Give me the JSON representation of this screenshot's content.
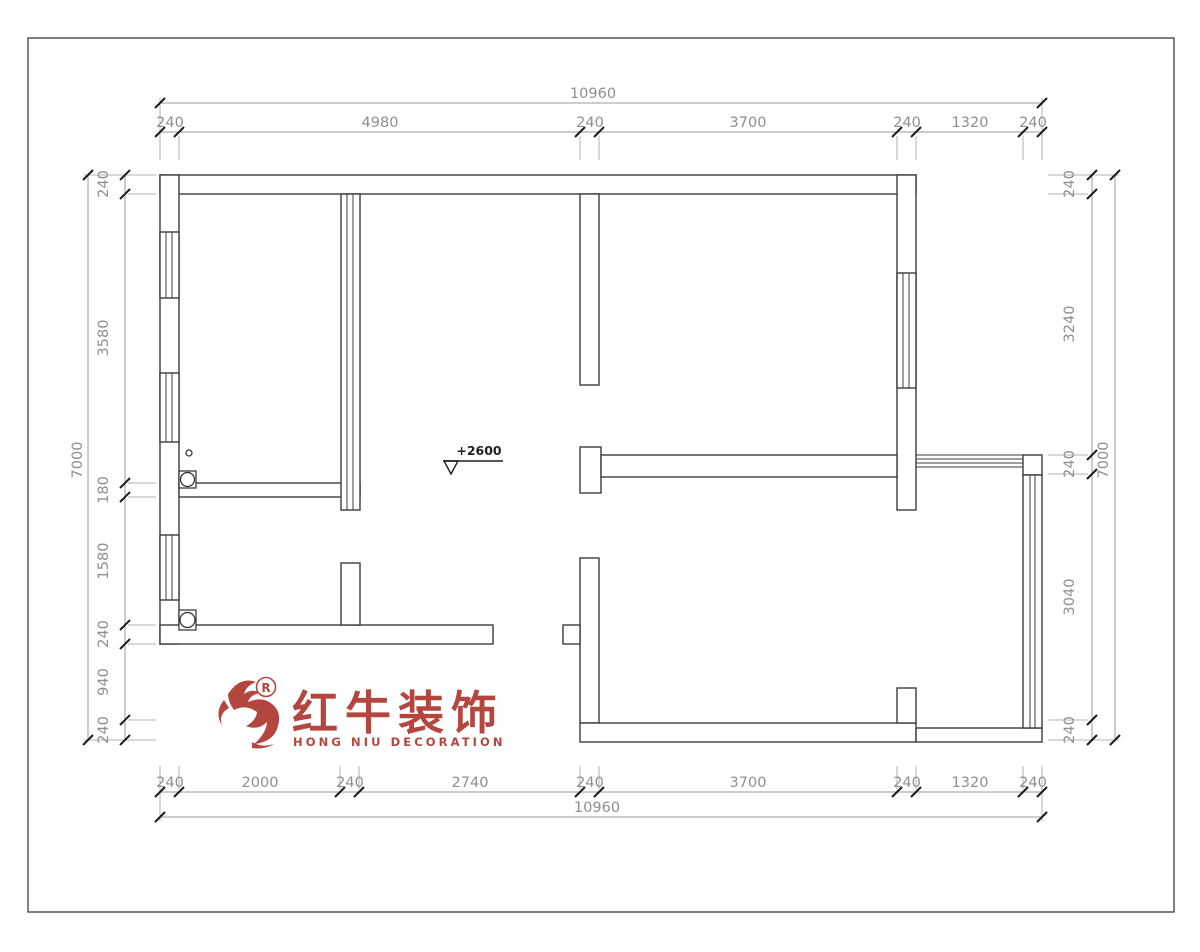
{
  "drawing": {
    "level_marker": "+2600",
    "dimensions": {
      "top": {
        "overall": "10960",
        "segments": [
          "240",
          "4980",
          "240",
          "3700",
          "240",
          "1320",
          "240"
        ]
      },
      "bottom": {
        "overall": "10960",
        "segments": [
          "240",
          "2000",
          "240",
          "2740",
          "240",
          "3700",
          "240",
          "1320",
          "240"
        ]
      },
      "left": {
        "overall": "7000",
        "segments": [
          "240",
          "3580",
          "180",
          "1580",
          "240",
          "940",
          "240"
        ]
      },
      "right": {
        "overall": "7000",
        "segments": [
          "240",
          "3240",
          "240",
          "3040",
          "240"
        ]
      }
    }
  },
  "logo": {
    "cn": "红牛装饰",
    "en": "HONG NIU DECORATION",
    "registered": "R",
    "color": "#b5463f"
  }
}
